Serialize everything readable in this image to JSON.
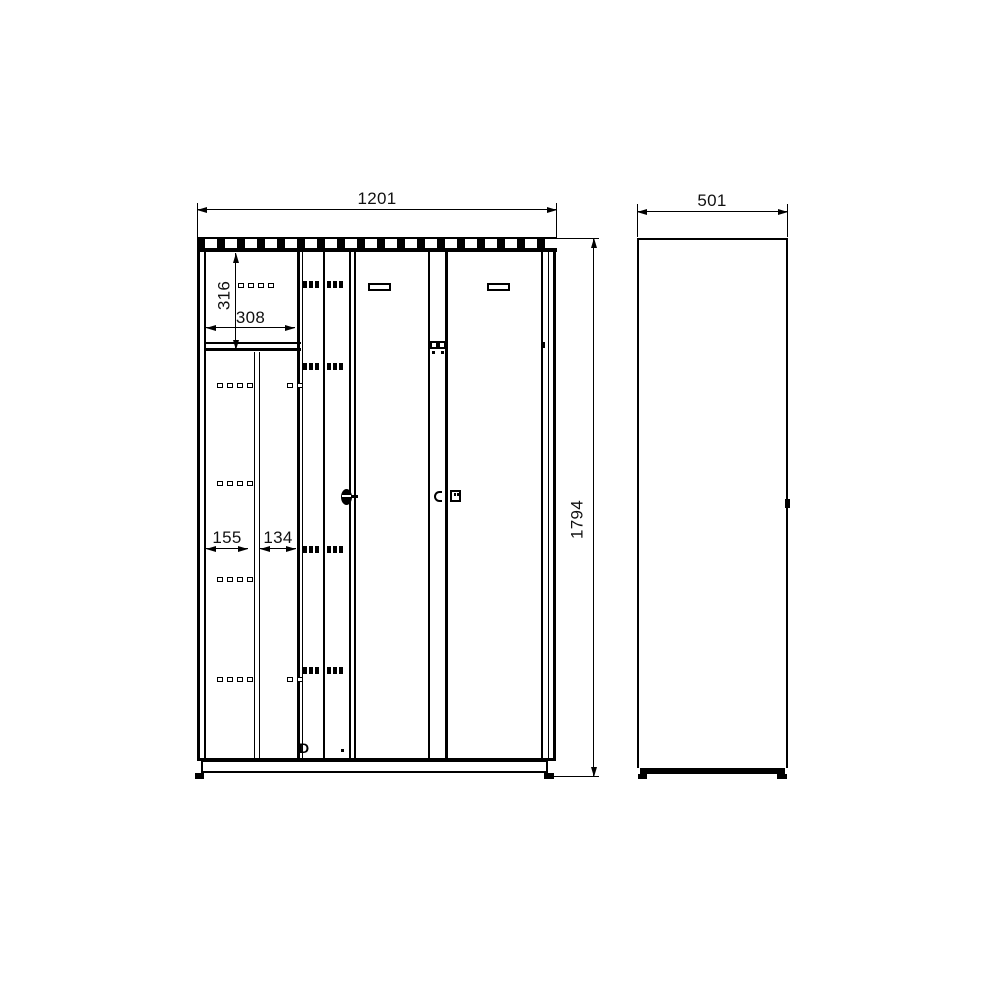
{
  "dimensions": {
    "front_width": "1201",
    "front_height": "1794",
    "side_depth": "501",
    "compartment_height": "316",
    "compartment_width": "308",
    "narrow_door_left_width": "155",
    "narrow_door_right_width": "134"
  },
  "marks": {
    "bottom_detail": "D"
  }
}
